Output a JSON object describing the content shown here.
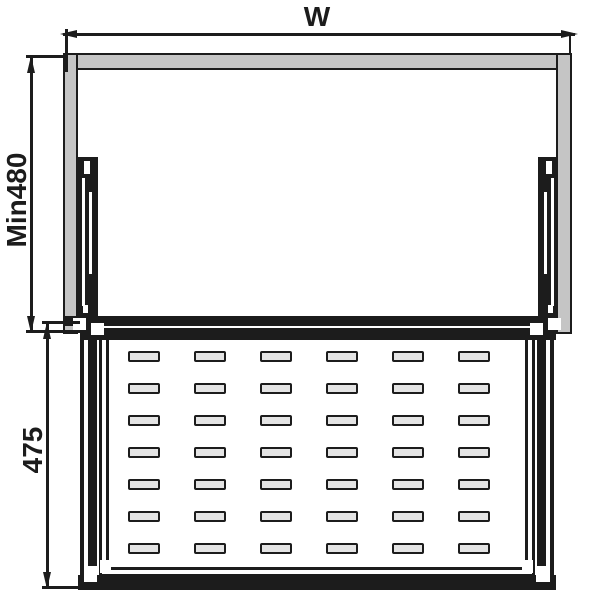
{
  "drawing": {
    "dimensions": {
      "width_label": "W",
      "min_height_label": "Min480",
      "basket_height_label": "475"
    },
    "basket": {
      "slot_rows": 7,
      "slot_cols": 6
    },
    "colors": {
      "line": "#1c1c1c",
      "panel": "#c5c5c5",
      "slot_fill": "#e4e4e4",
      "background": "#ffffff"
    }
  }
}
